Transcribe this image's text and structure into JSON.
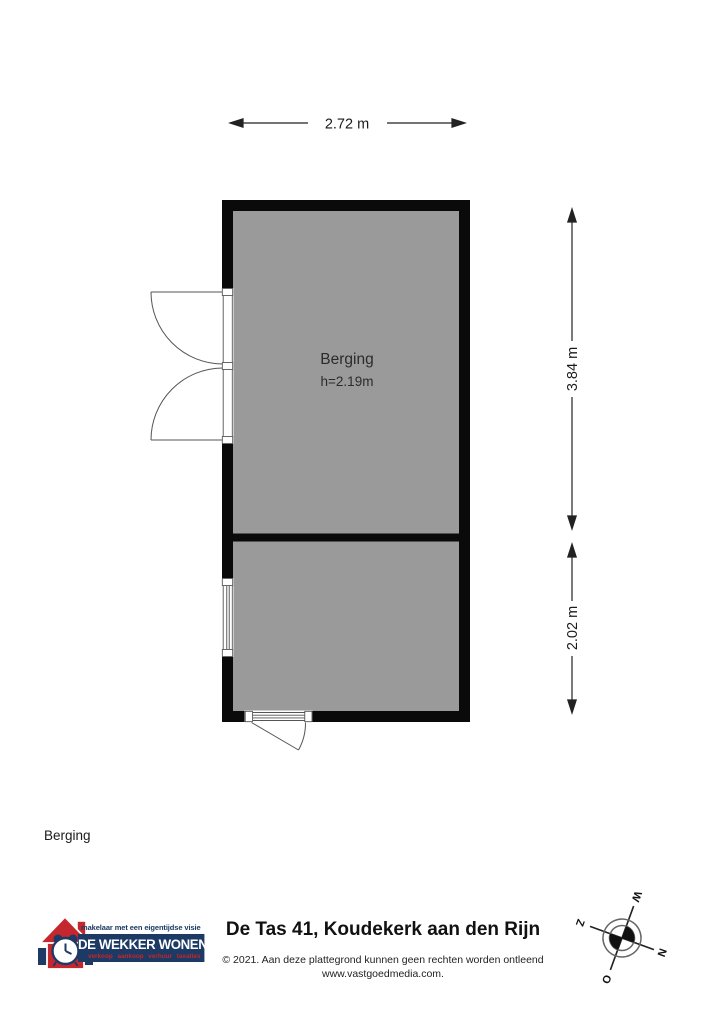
{
  "plan": {
    "dim_width": "2.72 m",
    "dim_height_upper": "3.84 m",
    "dim_height_lower": "2.02 m",
    "room": {
      "name": "Berging",
      "ceiling": "h=2.19m"
    },
    "fill_color": "#9a9a9a",
    "wall_color": "#0a0a0a"
  },
  "floor_label": "Berging",
  "footer": {
    "title": "De Tas 41, Koudekerk aan den Rijn",
    "disclaimer": "© 2021. Aan deze plattegrond kunnen geen rechten worden ontleend",
    "website": "www.vastgoedmedia.com.",
    "logo": {
      "tagline": "makelaar met een eigentijdse visie",
      "name": "DE WEKKER WONEN",
      "services": "verkoop aankoop verhuur taxaties",
      "navy": "#1c3a63",
      "red": "#c5262c"
    },
    "compass": {
      "north": "N",
      "south": "Z",
      "east": "O",
      "west": "W"
    }
  }
}
